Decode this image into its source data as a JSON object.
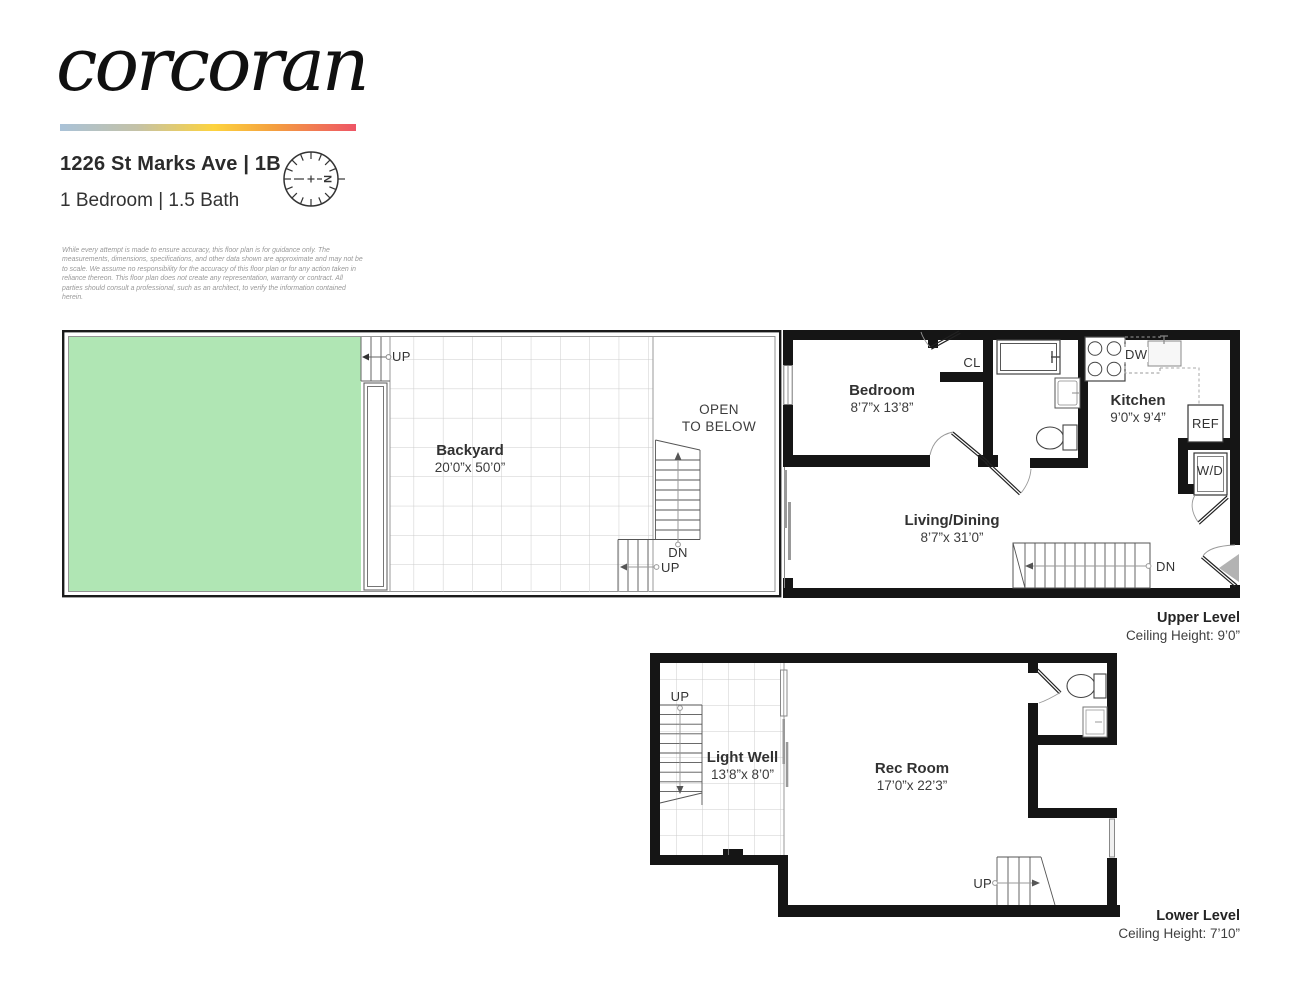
{
  "brand": {
    "logo": "corcoran"
  },
  "header": {
    "address": "1226 St Marks Ave | 1B",
    "summary": "1 Bedroom | 1.5 Bath",
    "compass_north": "N",
    "disclaimer": "While every attempt is made to ensure accuracy, this floor plan is for guidance only. The measurements, dimensions, specifications, and other data shown are approximate and may not be to scale. We assume no responsibility for the accuracy of this floor plan or for any action taken in reliance thereon. This floor plan does not create any representation, warranty or contract. All parties should consult a professional, such as an architect, to verify the information contained herein."
  },
  "upper_level": {
    "caption": {
      "title": "Upper Level",
      "ceiling": "Ceiling Height: 9’0”"
    },
    "backyard": {
      "name": "Backyard",
      "dims": "20’0”x 50’0”"
    },
    "open_to_below_line1": "OPEN",
    "open_to_below_line2": "TO BELOW",
    "bedroom": {
      "name": "Bedroom",
      "dims": "8’7”x 13’8”"
    },
    "kitchen": {
      "name": "Kitchen",
      "dims": "9’0”x 9’4”"
    },
    "living_dining": {
      "name": "Living/Dining",
      "dims": "8’7”x 31’0”"
    },
    "labels": {
      "closet": "CL",
      "dishwasher": "DW",
      "refrigerator": "REF",
      "washer_dryer": "W/D",
      "up_backyard": "UP",
      "up_mid": "UP",
      "dn_mid": "DN",
      "dn_entry": "DN"
    }
  },
  "lower_level": {
    "caption": {
      "title": "Lower Level",
      "ceiling": "Ceiling Height: 7’10”"
    },
    "light_well": {
      "name": "Light Well",
      "dims": "13’8”x 8’0”"
    },
    "rec_room": {
      "name": "Rec Room",
      "dims": "17’0”x 22’3”"
    },
    "labels": {
      "up_stair": "UP",
      "up_entry": "UP"
    }
  },
  "colors": {
    "grass": "#b0e6b4",
    "wall": "#151515",
    "entry_arrow": "#b3b3b3"
  }
}
